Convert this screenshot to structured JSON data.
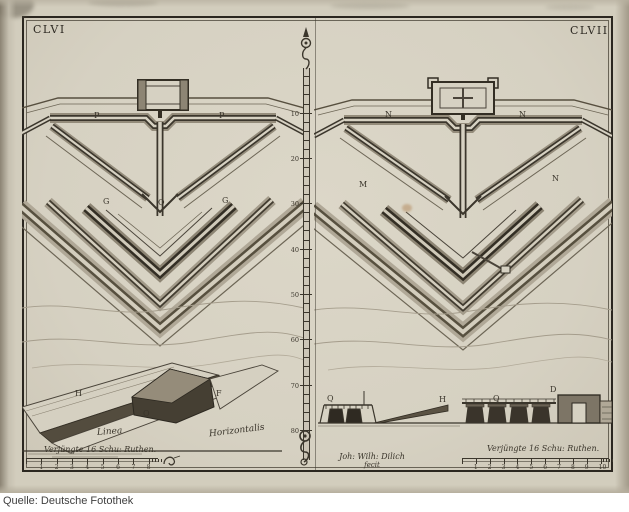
{
  "page_numbers": {
    "left": "CLVI",
    "right": "CLVII"
  },
  "ruler": {
    "labels": [
      5,
      10,
      20,
      30,
      40,
      50,
      60,
      70,
      80
    ]
  },
  "plan_left": {
    "letters": [
      "P",
      "P",
      "G",
      "Q",
      "G"
    ]
  },
  "plan_right": {
    "letters": [
      "N",
      "N",
      "M",
      "N"
    ]
  },
  "perspective": {
    "letters": [
      "H",
      "O",
      "F"
    ],
    "label_linea": "Linea",
    "label_horizontalis": "Horizontalis"
  },
  "profile_center": {
    "letters": [
      "Q",
      "H"
    ]
  },
  "profile_bridge": {
    "letters": [
      "Q",
      "D"
    ]
  },
  "scale_left": {
    "caption": "Verjüngte 16 Schu: Ruthen.",
    "numbers": [
      1,
      2,
      3,
      4,
      5,
      6,
      7,
      8
    ]
  },
  "scale_right": {
    "caption": "Verjüngte 16 Schu: Ruthen.",
    "numbers": [
      1,
      2,
      3,
      4,
      5,
      6,
      7,
      8,
      9,
      10
    ]
  },
  "signature": {
    "line1": "Joh: Wilh: Dilich",
    "line2": "fecit"
  },
  "footer": {
    "source_label": "Quelle: Deutsche Fotothek"
  },
  "colors": {
    "paper": "#d6d1c2",
    "ink": "#332e26",
    "footer_bg": "#ffffff",
    "footer_text": "#3f3f3f"
  }
}
